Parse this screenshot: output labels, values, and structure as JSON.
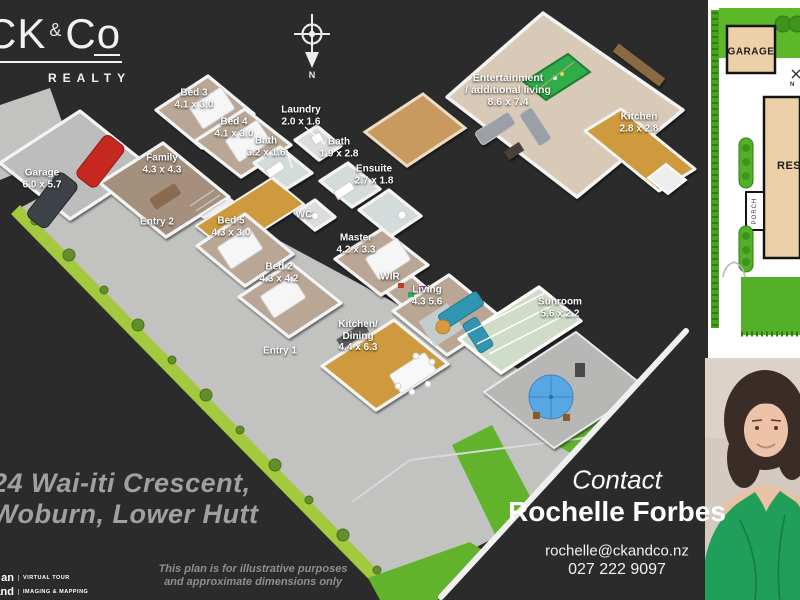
{
  "branding": {
    "logo_part1": "CK",
    "logo_amp": "&",
    "logo_part2": "Co",
    "tagline": "REALTY"
  },
  "compass": {
    "label": "N"
  },
  "floorplan": {
    "rooms": [
      {
        "name": "Garage",
        "dims": "6.0 x 5.7"
      },
      {
        "name": "Bed 3",
        "dims": "4.1 x 3.0"
      },
      {
        "name": "Bed 4",
        "dims": "4.1 x 3.0"
      },
      {
        "name": "Laundry",
        "dims": "2.0 x 1.6"
      },
      {
        "name": "Bath",
        "dims": "3.2 x 1.6"
      },
      {
        "name": "Bath",
        "dims": "1.9 x 2.8"
      },
      {
        "name": "Family",
        "dims": "4.3 x 4.3"
      },
      {
        "name": "Ensuite",
        "dims": "2.7 x 1.8"
      },
      {
        "name": "Entry 2"
      },
      {
        "name": "Bed 5",
        "dims": "4.3 x 3.0"
      },
      {
        "name": "WC"
      },
      {
        "name": "Master",
        "dims": "4.2 x 3.3"
      },
      {
        "name": "Bed 2",
        "dims": "4.3 x 4.2"
      },
      {
        "name": "WIR"
      },
      {
        "name": "Living",
        "dims": "4.3 5.6"
      },
      {
        "name": "Kitchen/",
        "name2": "Dining",
        "dims": "4.4 x 6.3"
      },
      {
        "name": "Entry 1"
      },
      {
        "name": "Sunroom",
        "dims": "5.6 x 2.2"
      },
      {
        "name": "Entertainment",
        "name2": "/ additional living",
        "dims": "8.6 x 7.4"
      },
      {
        "name": "Kitchen",
        "dims": "2.8 x 2.8"
      }
    ]
  },
  "site_plan": {
    "garage_label": "GARAGE",
    "residence_label": "RESIDENCE",
    "porch_label": "PORCH",
    "compass_label": "N"
  },
  "address": {
    "line1": "24 Wai-iti Crescent,",
    "line2": "Woburn, Lower Hutt"
  },
  "disclaimer": {
    "line1": "This plan is for illustrative purposes",
    "line2": "and approximate dimensions only"
  },
  "contact": {
    "heading": "Contact",
    "name": "Rochelle Forbes",
    "email": "rochelle@ckandco.nz",
    "phone": "027 222 9097"
  },
  "badges": {
    "prefix1": "an",
    "label1": "VIRTUAL TOUR",
    "prefix2": "and",
    "label2": "IMAGING & MAPPING"
  },
  "colors": {
    "background": "#2b2b2b",
    "driveway": "#c2c2c0",
    "lawn_strip": "#a3c93f",
    "site_lawn": "#54b028",
    "wood_floor": "#cf9a3d",
    "carpet": "#b9a694",
    "couch_teal": "#2f95b0",
    "agent_top_green": "#1f9f59",
    "building_tan": "#ecd0a7"
  }
}
